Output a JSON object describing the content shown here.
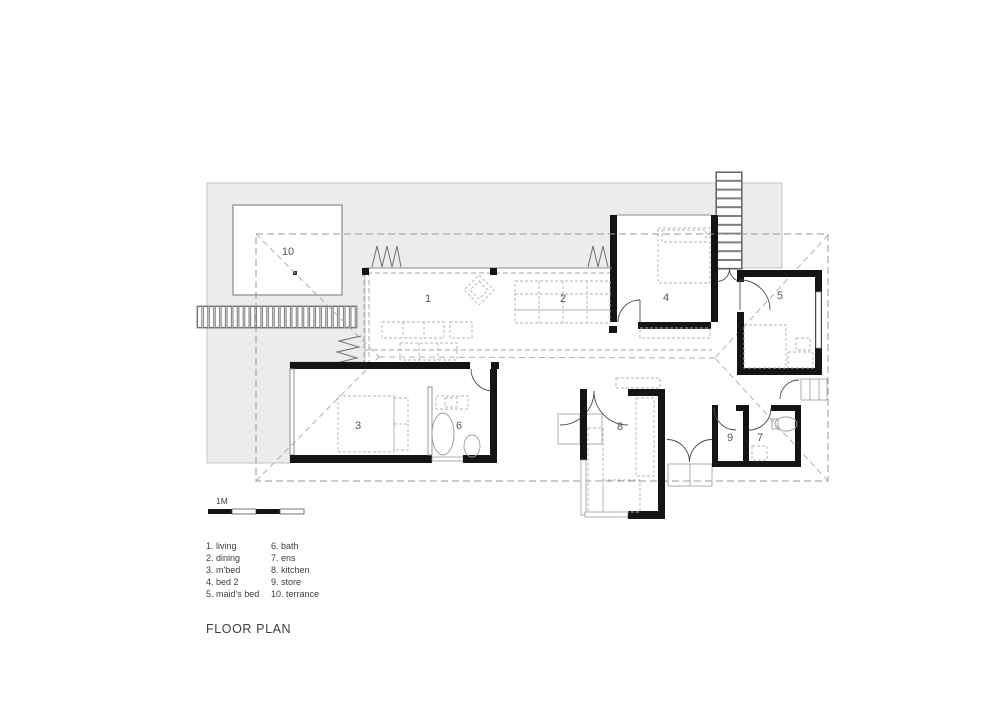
{
  "title": "FLOOR PLAN",
  "scale_bar": {
    "label": "1M"
  },
  "rooms": [
    {
      "num": "1",
      "name": "living"
    },
    {
      "num": "2",
      "name": "dining"
    },
    {
      "num": "3",
      "name": "m'bed"
    },
    {
      "num": "4",
      "name": "bed 2"
    },
    {
      "num": "5",
      "name": "maid's bed"
    },
    {
      "num": "6",
      "name": "bath"
    },
    {
      "num": "7",
      "name": "ens"
    },
    {
      "num": "8",
      "name": "kitchen"
    },
    {
      "num": "9",
      "name": "store"
    },
    {
      "num": "10",
      "name": "terrance"
    }
  ],
  "legend": {
    "col1": [
      "1. living",
      "2. dining",
      "3. m'bed",
      "4. bed 2",
      "5. maid's bed"
    ],
    "col2": [
      "6. bath",
      "7. ens",
      "8. kitchen",
      "9. store",
      "10. terrance"
    ]
  },
  "colors": {
    "wall": "#151515",
    "terrace_fill": "#ececec",
    "roof_dash": "#9a9a9a",
    "label": "#565656",
    "paper": "#ffffff"
  }
}
